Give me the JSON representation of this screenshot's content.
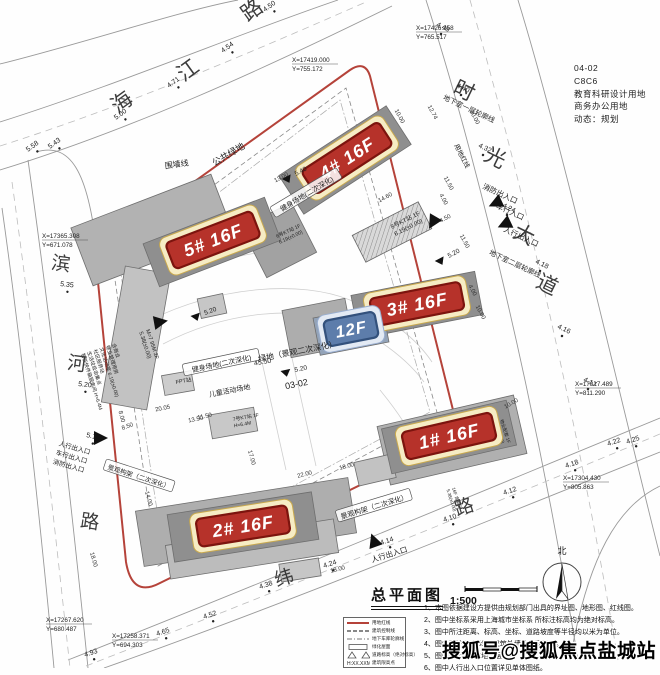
{
  "title_block": {
    "title": "总平面图",
    "scale": "1:500"
  },
  "north_label": "北",
  "watermark": "搜狐号@搜狐焦点盐城站",
  "info_block": [
    "04-02",
    "C8C6",
    "教育科研设计用地",
    "商务办公用地",
    "动态：规划"
  ],
  "notes": [
    "1、本图依据建设方提供由规划部门出具的界址图、地形图、红线图。",
    "2、图中坐标系采用上海城市坐标系 所标注标高均为绝对标高。",
    "3、图中所注距离、标高、坐标、道路坡度等半径均以米为单位。",
    "4、图中所注距离 均为建筑外墙外皮间距离。",
    "5、图中F表示建筑地上层数。",
    "6、图中人行出入口位置详见单体图纸。"
  ],
  "legend": [
    {
      "sym": "redline",
      "label": "用地红线"
    },
    {
      "sym": "dashed",
      "label": "建筑控制线"
    },
    {
      "sym": "dashdot",
      "label": "地下车库轮廓线"
    },
    {
      "sym": "rect",
      "label": "绿化屋面"
    },
    {
      "sym": "levels",
      "label": "道路标高（绝对标高）"
    },
    {
      "sym": "height",
      "label": "建筑限高点"
    }
  ],
  "road_labels": [
    {
      "t": "海",
      "x": 126,
      "y": 108,
      "r": -36,
      "s": 21
    },
    {
      "t": "江",
      "x": 192,
      "y": 76,
      "r": -36,
      "s": 21
    },
    {
      "t": "路",
      "x": 256,
      "y": 16,
      "r": -36,
      "s": 21
    },
    {
      "t": "时",
      "x": 461,
      "y": 97,
      "r": 26,
      "s": 21
    },
    {
      "t": "光",
      "x": 492,
      "y": 164,
      "r": 26,
      "s": 21
    },
    {
      "t": "大",
      "x": 521,
      "y": 241,
      "r": 26,
      "s": 21
    },
    {
      "t": "道",
      "x": 544,
      "y": 291,
      "r": 26,
      "s": 21
    },
    {
      "t": "滨",
      "x": 60,
      "y": 270,
      "r": 8,
      "s": 19
    },
    {
      "t": "河",
      "x": 76,
      "y": 370,
      "r": 8,
      "s": 19
    },
    {
      "t": "路",
      "x": 89,
      "y": 528,
      "r": 8,
      "s": 19
    },
    {
      "t": "纬",
      "x": 286,
      "y": 584,
      "r": -18,
      "s": 19
    },
    {
      "t": "路",
      "x": 466,
      "y": 513,
      "r": -18,
      "s": 19
    }
  ],
  "building_labels": [
    {
      "t": "4# 16F",
      "x": 347,
      "y": 158,
      "r": -33,
      "w": 92,
      "h": 28,
      "style": "red"
    },
    {
      "t": "5# 16F",
      "x": 213,
      "y": 240,
      "r": -21,
      "w": 92,
      "h": 28,
      "style": "red"
    },
    {
      "t": "3# 16F",
      "x": 417,
      "y": 304,
      "r": -11,
      "w": 92,
      "h": 28,
      "style": "red"
    },
    {
      "t": "1# 16F",
      "x": 449,
      "y": 436,
      "r": -13,
      "w": 92,
      "h": 28,
      "style": "red"
    },
    {
      "t": "2# 16F",
      "x": 243,
      "y": 526,
      "r": -9,
      "w": 92,
      "h": 28,
      "style": "red"
    },
    {
      "t": "12F",
      "x": 351,
      "y": 329,
      "r": -11,
      "w": 52,
      "h": 26,
      "style": "blue"
    }
  ],
  "buildings": [
    {
      "x": 152,
      "y": 230,
      "w": 150,
      "h": 62,
      "r": -21,
      "f": "#b2b2b2"
    },
    {
      "x": 136,
      "y": 338,
      "w": 46,
      "h": 138,
      "r": 10,
      "f": "#c2c2c2"
    },
    {
      "x": 279,
      "y": 240,
      "w": 56,
      "h": 56,
      "r": -27,
      "f": "#a2a2a2"
    },
    {
      "x": 318,
      "y": 328,
      "w": 64,
      "h": 48,
      "r": -11,
      "f": "#adadad"
    },
    {
      "x": 452,
      "y": 440,
      "w": 140,
      "h": 60,
      "r": -13,
      "f": "#b0b0b0"
    },
    {
      "x": 246,
      "y": 522,
      "w": 215,
      "h": 56,
      "r": -9,
      "f": "#aeaeae"
    },
    {
      "x": 252,
      "y": 549,
      "w": 170,
      "h": 34,
      "r": -9,
      "f": "#bcbcbc"
    },
    {
      "x": 212,
      "y": 306,
      "w": 26,
      "h": 20,
      "r": -12,
      "f": "#c6c6c6"
    },
    {
      "x": 178,
      "y": 383,
      "w": 30,
      "h": 20,
      "r": -10,
      "f": "#cccccc"
    },
    {
      "x": 233,
      "y": 423,
      "w": 46,
      "h": 24,
      "r": -10,
      "f": "#c8c8c8"
    },
    {
      "x": 375,
      "y": 470,
      "w": 38,
      "h": 24,
      "r": -13,
      "f": "#c2c2c2"
    },
    {
      "x": 300,
      "y": 570,
      "w": 40,
      "h": 18,
      "r": -9,
      "f": "#c6c6c6"
    },
    {
      "x": 345,
      "y": 160,
      "w": 128,
      "h": 46,
      "r": -33,
      "f": "#8f8f8f"
    },
    {
      "x": 212,
      "y": 242,
      "w": 130,
      "h": 46,
      "r": -21,
      "f": "#8f8f8f"
    },
    {
      "x": 417,
      "y": 305,
      "w": 126,
      "h": 44,
      "r": -11,
      "f": "#8f8f8f"
    },
    {
      "x": 449,
      "y": 437,
      "w": 128,
      "h": 46,
      "r": -13,
      "f": "#8f8f8f"
    },
    {
      "x": 243,
      "y": 527,
      "w": 146,
      "h": 48,
      "r": -9,
      "f": "#8f8f8f"
    },
    {
      "x": 351,
      "y": 330,
      "w": 70,
      "h": 38,
      "r": -11,
      "f": "#93a3b8"
    }
  ],
  "hatched": [
    {
      "x": 392,
      "y": 232,
      "w": 74,
      "h": 30,
      "r": -27
    }
  ],
  "elevations": [
    {
      "v": "5.00",
      "x": 116,
      "y": 120,
      "r": -36
    },
    {
      "v": "4.71",
      "x": 169,
      "y": 88,
      "r": -36
    },
    {
      "v": "4.54",
      "x": 223,
      "y": 53,
      "r": -36
    },
    {
      "v": "4.50",
      "x": 265,
      "y": 12,
      "r": -36
    },
    {
      "v": "5.58",
      "x": 28,
      "y": 152,
      "r": -36
    },
    {
      "v": "5.43",
      "x": 50,
      "y": 149,
      "r": -36
    },
    {
      "v": "4.48",
      "x": 436,
      "y": 26,
      "r": 26
    },
    {
      "v": "4.40",
      "x": 456,
      "y": 87,
      "r": 26
    },
    {
      "v": "4.32",
      "x": 478,
      "y": 147,
      "r": 26
    },
    {
      "v": "4.24",
      "x": 502,
      "y": 207,
      "r": 26
    },
    {
      "v": "4.18",
      "x": 535,
      "y": 263,
      "r": 26
    },
    {
      "v": "4.16",
      "x": 557,
      "y": 328,
      "r": 26
    },
    {
      "v": "4.17",
      "x": 583,
      "y": 381,
      "r": 26
    },
    {
      "v": "4.22",
      "x": 608,
      "y": 446,
      "r": -18
    },
    {
      "v": "4.25",
      "x": 627,
      "y": 444,
      "r": -18
    },
    {
      "v": "4.18",
      "x": 566,
      "y": 468,
      "r": -18
    },
    {
      "v": "4.12",
      "x": 504,
      "y": 495,
      "r": -18
    },
    {
      "v": "4.10",
      "x": 444,
      "y": 522,
      "r": -18
    },
    {
      "v": "4.14",
      "x": 381,
      "y": 545,
      "r": -18
    },
    {
      "v": "4.24",
      "x": 324,
      "y": 568,
      "r": -18
    },
    {
      "v": "4.38",
      "x": 260,
      "y": 589,
      "r": -18
    },
    {
      "v": "5.35",
      "x": 60,
      "y": 286,
      "r": 6
    },
    {
      "v": "5.20",
      "x": 78,
      "y": 386,
      "r": 6
    },
    {
      "v": "5.15",
      "x": 86,
      "y": 437,
      "r": 12
    },
    {
      "v": "4.52",
      "x": 204,
      "y": 619,
      "r": -18
    },
    {
      "v": "4.65",
      "x": 157,
      "y": 636,
      "r": -18
    },
    {
      "v": "4.93",
      "x": 85,
      "y": 657,
      "r": -18
    }
  ],
  "markers": [
    {
      "v": "5.20",
      "x": 295,
      "y": 372,
      "r": -12
    },
    {
      "v": "5.20",
      "x": 449,
      "y": 258,
      "r": -28
    },
    {
      "v": "5.40",
      "x": 296,
      "y": 176,
      "r": -28
    },
    {
      "v": "5.20",
      "x": 205,
      "y": 315,
      "r": -20
    }
  ],
  "coords": [
    {
      "a": "X=17419.000",
      "b": "Y=755.172",
      "x": 292,
      "y": 62
    },
    {
      "a": "X=17426.358",
      "b": "Y=765.517",
      "x": 416,
      "y": 30
    },
    {
      "a": "X=17365.308",
      "b": "Y=671.078",
      "x": 42,
      "y": 238
    },
    {
      "a": "X=17317.489",
      "b": "Y=811.290",
      "x": 575,
      "y": 386
    },
    {
      "a": "X=17304.430",
      "b": "Y=805.863",
      "x": 563,
      "y": 480
    },
    {
      "a": "X=17267.620",
      "b": "Y=680.487",
      "x": 46,
      "y": 622
    },
    {
      "a": "X=17258.371",
      "b": "Y=694.303",
      "x": 112,
      "y": 638
    }
  ],
  "site_labels": [
    {
      "t": "公共绿地",
      "x": 230,
      "y": 157,
      "r": -31,
      "s": 9
    },
    {
      "t": "围墙线",
      "x": 177,
      "y": 167,
      "r": -8,
      "s": 8
    },
    {
      "t": "健身场地(二次深化)",
      "x": 308,
      "y": 196,
      "r": -31,
      "s": 7,
      "boxed": true
    },
    {
      "t": "健身场地(二次深化)",
      "x": 222,
      "y": 366,
      "r": -12,
      "s": 7,
      "boxed": true
    },
    {
      "t": "绿地（景观二次深化）",
      "x": 298,
      "y": 354,
      "r": -11,
      "s": 8
    },
    {
      "t": "45.50",
      "x": 263,
      "y": 364,
      "r": -11,
      "s": 7
    },
    {
      "t": "儿童活动场地",
      "x": 230,
      "y": 393,
      "r": -11,
      "s": 7
    },
    {
      "t": "03-02",
      "x": 297,
      "y": 387,
      "r": -11,
      "s": 9
    },
    {
      "t": "景观构架（二次深化）",
      "x": 375,
      "y": 509,
      "r": -17,
      "s": 7,
      "boxed": true
    },
    {
      "t": "景观构架（二次深化）",
      "x": 138,
      "y": 479,
      "r": 18,
      "s": 6.5,
      "boxed": true
    },
    {
      "t": "地下室一层轮廓线",
      "x": 468,
      "y": 111,
      "r": 25,
      "s": 7
    },
    {
      "t": "地下室二层轮廓线",
      "x": 514,
      "y": 266,
      "r": 25,
      "s": 7
    },
    {
      "t": "用地红线",
      "x": 460,
      "y": 157,
      "r": 63,
      "s": 6.5
    },
    {
      "t": "消防出入口",
      "x": 499,
      "y": 196,
      "r": 25,
      "s": 7.5
    },
    {
      "t": "车行入口",
      "x": 509,
      "y": 214,
      "r": 25,
      "s": 7.5
    },
    {
      "t": "人行出入口",
      "x": 520,
      "y": 239,
      "r": 25,
      "s": 7.5
    },
    {
      "t": "人行出入口",
      "x": 390,
      "y": 557,
      "r": -17,
      "s": 7.5
    },
    {
      "t": "人行出入口",
      "x": 74,
      "y": 450,
      "r": 16,
      "s": 6.5
    },
    {
      "t": "车行出入口",
      "x": 71,
      "y": 459,
      "r": 16,
      "s": 6.5
    },
    {
      "t": "消防出入口",
      "x": 68,
      "y": 468,
      "r": 16,
      "s": 6.5
    }
  ],
  "dims": [
    {
      "v": "10.00",
      "x": 398,
      "y": 117,
      "r": 62
    },
    {
      "v": "12.74",
      "x": 431,
      "y": 113,
      "r": 62
    },
    {
      "v": "30.00",
      "x": 473,
      "y": 118,
      "r": 62
    },
    {
      "v": "11.50",
      "x": 447,
      "y": 184,
      "r": 62
    },
    {
      "v": "14.60",
      "x": 386,
      "y": 199,
      "r": -28
    },
    {
      "v": "4.00",
      "x": 442,
      "y": 200,
      "r": 62
    },
    {
      "v": "4.50",
      "x": 446,
      "y": 220,
      "r": -28
    },
    {
      "v": "11.50",
      "x": 463,
      "y": 242,
      "r": 62
    },
    {
      "v": "4.00",
      "x": 471,
      "y": 291,
      "r": 62
    },
    {
      "v": "10.00",
      "x": 479,
      "y": 313,
      "r": 62
    },
    {
      "v": "13.00",
      "x": 282,
      "y": 179,
      "r": -28
    },
    {
      "v": "13.50",
      "x": 196,
      "y": 421,
      "r": -12
    },
    {
      "v": "20.05",
      "x": 163,
      "y": 410,
      "r": -12
    },
    {
      "v": "11.50",
      "x": 205,
      "y": 418,
      "r": -12
    },
    {
      "v": "8.00",
      "x": 120,
      "y": 417,
      "r": 75
    },
    {
      "v": "8.50",
      "x": 128,
      "y": 428,
      "r": -20
    },
    {
      "v": "14.00",
      "x": 147,
      "y": 499,
      "r": 75
    },
    {
      "v": "17.00",
      "x": 250,
      "y": 458,
      "r": 75
    },
    {
      "v": "18.00",
      "x": 347,
      "y": 468,
      "r": -14
    },
    {
      "v": "22.00",
      "x": 305,
      "y": 476,
      "r": -14
    },
    {
      "v": "18.00",
      "x": 338,
      "y": 571,
      "r": -14
    },
    {
      "v": "18.00",
      "x": 92,
      "y": 560,
      "r": 75
    },
    {
      "v": "10.00",
      "x": 512,
      "y": 405,
      "r": -30
    }
  ],
  "entrances": [
    {
      "x": 100,
      "y": 438,
      "r": 90
    },
    {
      "x": 505,
      "y": 224,
      "r": -115
    },
    {
      "x": 496,
      "y": 203,
      "r": -115
    },
    {
      "x": 374,
      "y": 541,
      "r": -20
    },
    {
      "x": 433,
      "y": 222,
      "r": -150
    },
    {
      "x": 160,
      "y": 322,
      "r": 80
    }
  ],
  "micro_texts": [
    {
      "lines": [
        "M=7 95M 2F",
        "5.38(±0.00)"
      ],
      "x": 146,
      "y": 330,
      "r": 72,
      "s": 5.5
    },
    {
      "lines": [
        "含商业",
        "物业管理用房",
        "文化活动室 6.19(±0.00)",
        "社区服务站",
        "生活垃圾收集点",
        "智能快件箱服务间 H=6.4M"
      ],
      "x": 112,
      "y": 344,
      "r": 72,
      "s": 5
    },
    {
      "lines": [
        "8号KT站 1F",
        "6.19(±0.00)"
      ],
      "x": 392,
      "y": 229,
      "r": -27,
      "s": 6
    },
    {
      "lines": [
        "6号KT站 1F",
        "6.19(±0.00)"
      ],
      "x": 277,
      "y": 238,
      "r": -25,
      "s": 5
    },
    {
      "lines": [
        "7号KT站 1F",
        "H=6.4M"
      ],
      "x": 233,
      "y": 421,
      "r": -10,
      "s": 5
    },
    {
      "lines": [
        "FPT站"
      ],
      "x": 176,
      "y": 384,
      "r": -10,
      "s": 5.5
    },
    {
      "lines": [
        "16F 含商业",
        "5.38(±0.00)"
      ],
      "x": 452,
      "y": 488,
      "r": 72,
      "s": 4.5
    },
    {
      "lines": [
        "物业配套 1F",
        "6.19(±0.00)"
      ],
      "x": 500,
      "y": 420,
      "r": 72,
      "s": 4.5
    }
  ]
}
